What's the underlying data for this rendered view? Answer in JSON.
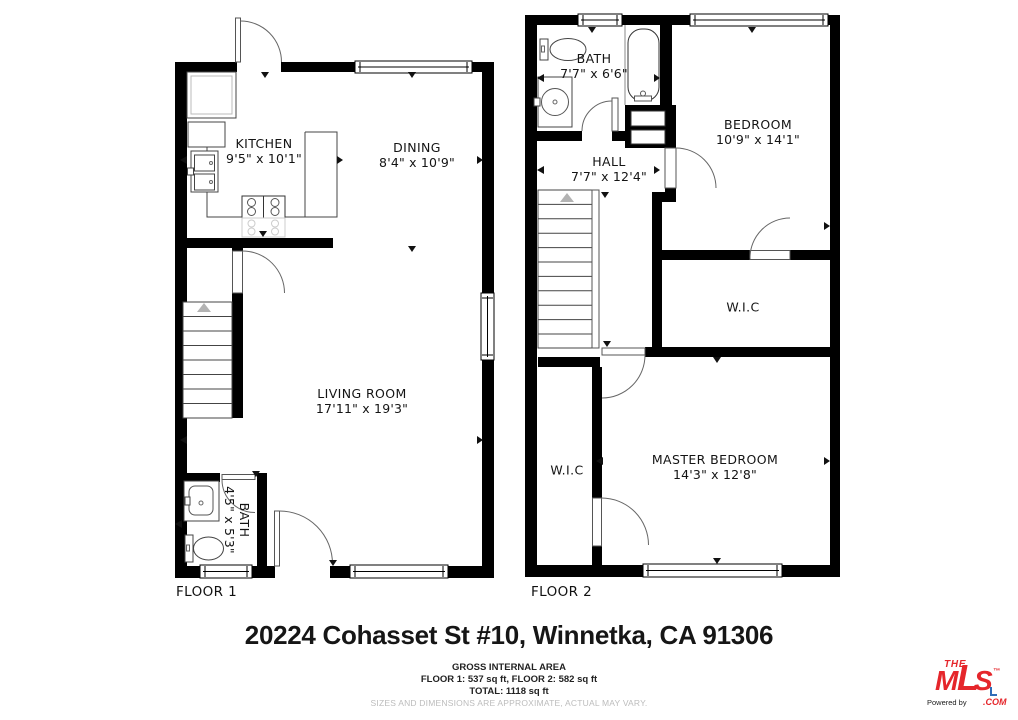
{
  "floors": [
    {
      "label": "FLOOR 1",
      "rooms": [
        {
          "key": "kitchen",
          "name": "KITCHEN",
          "dims": "9'5\" x 10'1\""
        },
        {
          "key": "dining",
          "name": "DINING",
          "dims": "8'4\" x 10'9\""
        },
        {
          "key": "living",
          "name": "LIVING ROOM",
          "dims": "17'11\" x 19'3\""
        },
        {
          "key": "bath1",
          "name": "BATH",
          "dims": "4'5\" x 5'3\""
        }
      ]
    },
    {
      "label": "FLOOR 2",
      "rooms": [
        {
          "key": "bath2",
          "name": "BATH",
          "dims": "7'7\" x 6'6\""
        },
        {
          "key": "hall",
          "name": "HALL",
          "dims": "7'7\" x 12'4\""
        },
        {
          "key": "bedroom",
          "name": "BEDROOM",
          "dims": "10'9\" x 14'1\""
        },
        {
          "key": "wic_upper",
          "name": "W.I.C",
          "dims": ""
        },
        {
          "key": "master",
          "name": "MASTER BEDROOM",
          "dims": "14'3\" x 12'8\""
        },
        {
          "key": "wic_lower",
          "name": "W.I.C",
          "dims": ""
        }
      ]
    }
  ],
  "footer": {
    "address": "20224 Cohasset St #10, Winnetka, CA 91306",
    "area_heading": "GROSS INTERNAL AREA",
    "area_line1": "FLOOR 1: 537 sq ft, FLOOR 2: 582 sq ft",
    "area_line2": "TOTAL: 1118 sq ft",
    "disclaimer": "SIZES AND DIMENSIONS ARE APPROXIMATE, ACTUAL MAY VARY."
  },
  "logo": {
    "the": "THE",
    "m": "M",
    "l": "L",
    "s": "S",
    "tm": "™",
    "com": ".COM",
    "powered_by": "Powered by",
    "brand_red": "#e5262b",
    "accent_blue": "#2f6db8"
  }
}
